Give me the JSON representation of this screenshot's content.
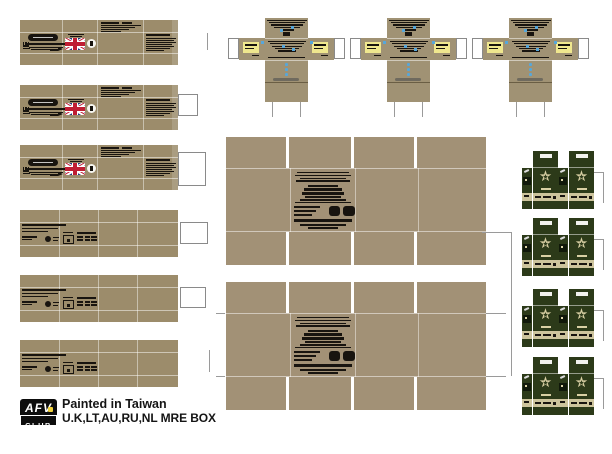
{
  "footer": {
    "brand_top": "AFV",
    "brand_bottom": "CLUB",
    "made_in": "Painted in Taiwan",
    "product": "U.K,LT,AU,RU,NL MRE BOX"
  },
  "icons": {
    "star_glyph": "★"
  },
  "colors": {
    "cardboard_strip": "#9c8c6b",
    "cardboard_case": "#a29176",
    "cardboard_cross": "#a09274",
    "print_dark": "#18140f",
    "guide_gray": "#9a9a9a",
    "flap_white": "#ffffff",
    "flap_border": "#8a8a8a",
    "flag_navy": "#23387d",
    "flag_red": "#bf1d33",
    "label_yellow": "#efe78e",
    "accent_blue": "#57a7da",
    "green_box": "#2c3a19",
    "green_dark": "#10180a",
    "star_cream": "#d9d0a4",
    "band_cream": "#cdc49c",
    "smudge_gray": "#6f6a5e",
    "logo_yellow": "#f0d23c"
  },
  "layout_counts": {
    "uk_strips": 3,
    "plain_strips": 3,
    "cross_boxes": 3,
    "large_cases": 2,
    "green_groups": 4
  }
}
